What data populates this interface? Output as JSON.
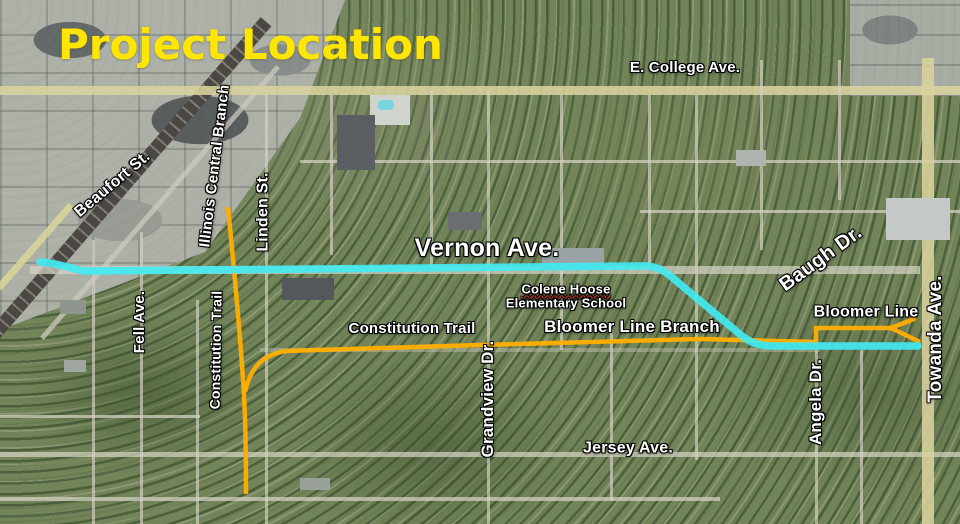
{
  "title": {
    "text": "Project Location",
    "color": "#ffe600"
  },
  "labels": {
    "e_college_ave": "E. College Ave.",
    "beaufort_st": "Beaufort St.",
    "illinois_central_branch": "Illinois Central Branch",
    "linden_st": "Linden St.",
    "vernon_ave": "Vernon Ave.",
    "school_line1": "Colene Hoose",
    "school_line2": "Elementary School",
    "fell_ave": "Fell Ave.",
    "constitution_trail_vertical": "Constitution Trail",
    "constitution_trail_horizontal": "Constitution Trail",
    "grandview_dr": "Grandview Dr.",
    "bloomer_line_branch": "Bloomer Line Branch",
    "baugh_dr": "Baugh Dr.",
    "bloomer_line": "Bloomer Line",
    "towanda_ave": "Towanda Ave.",
    "angela_dr": "Angela Dr.",
    "jersey_ave": "Jersey Ave."
  },
  "routes": {
    "vernon_corridor": {
      "name": "Vernon Ave. project corridor highlight",
      "color": "#42e9f1"
    },
    "trail_corridor": {
      "name": "Constitution Trail / Bloomer Line Branch highlight",
      "color": "#ffaf00"
    }
  },
  "label_style": {
    "text_color": "#ffffff",
    "outline_color": "#000000"
  }
}
